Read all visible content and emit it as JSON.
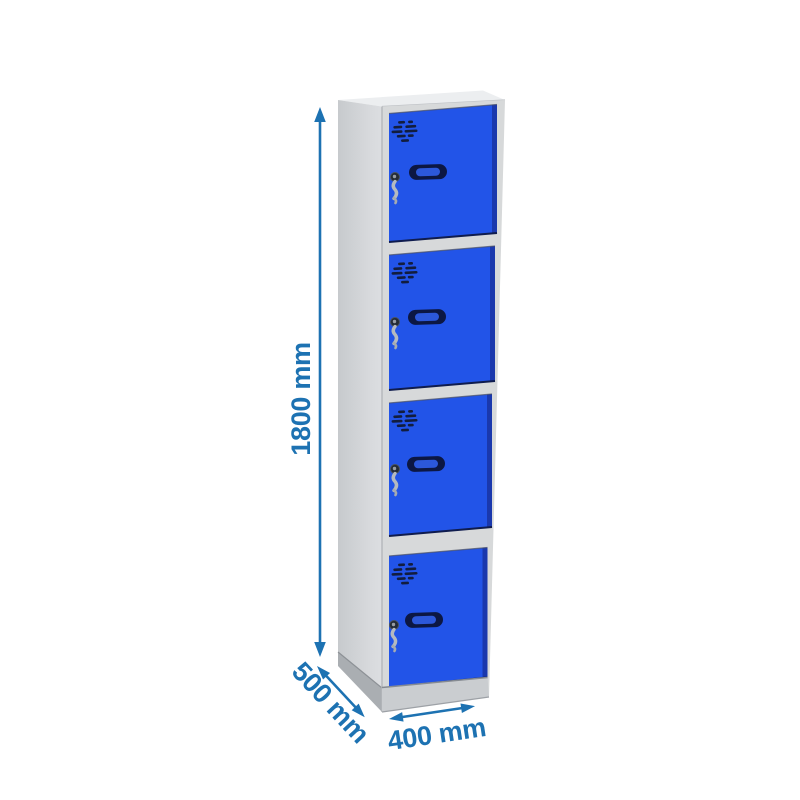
{
  "page": {
    "background": "#ffffff",
    "description": "Dimension diagram of a grey four-door locker column with blue doors"
  },
  "product": {
    "name": "four-door locker column",
    "door_count": 4,
    "body_color_name": "grey",
    "door_color_name": "blue",
    "parts": [
      "vent-grille",
      "door-handle",
      "lock-with-key",
      "plinth-base"
    ]
  },
  "annotations": {
    "height": {
      "label": "1800 mm",
      "value_mm": 1800,
      "axis": "vertical"
    },
    "depth": {
      "label": "500 mm",
      "value_mm": 500,
      "axis": "diagonal"
    },
    "width": {
      "label": "400 mm",
      "value_mm": 400,
      "axis": "horizontal"
    }
  },
  "colors": {
    "annotation_blue": "#1d72b2",
    "door_blue": "#2254e8",
    "door_blue_shadow": "#1a38ad",
    "door_edge_dark": "#0f1c4e",
    "handle_navy": "#0c1743",
    "handle_slot_blue": "#2c58da",
    "vent_dark": "#121d3e",
    "front_grey": "#d7d9da",
    "side_grey_back": "#c7cacd",
    "side_grey_front": "#dcdee1",
    "top_grey": "#eceef0",
    "plinth_grey": "#cacdd0",
    "underside_grey": "#aaaeb2",
    "key_silver": "#b5bac0"
  }
}
